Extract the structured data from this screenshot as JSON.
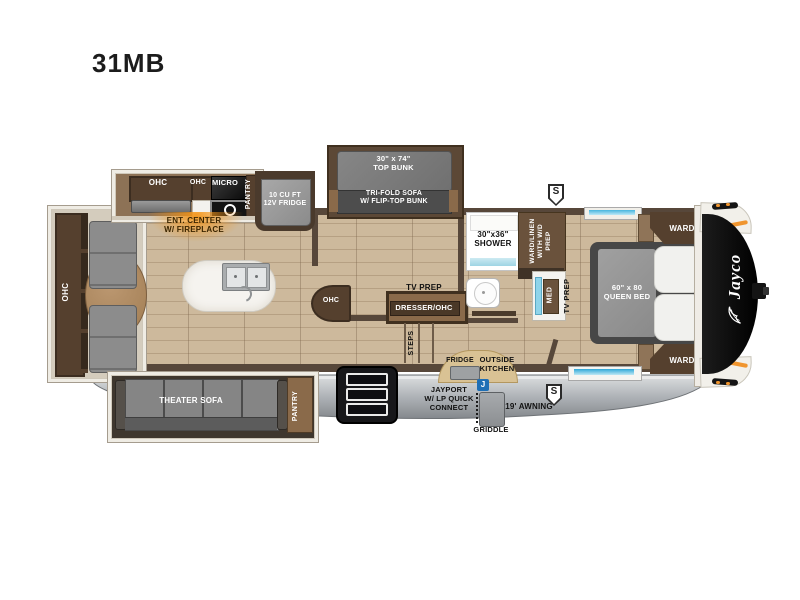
{
  "title": "31MB",
  "colors": {
    "wall_brown": "#57473a",
    "floor_tan": "#cbb79a",
    "accent_orange": "#f0952e",
    "window_blue": "#45b4dd",
    "jayport_blue": "#1f6fb5",
    "skirt_gray": "#b4b8bc"
  },
  "rear": {
    "ohc": "OHC"
  },
  "kitchen": {
    "ohc_large": "OHC",
    "ohc_small": "OHC",
    "micro": "MICRO",
    "pantry": "PANTRY",
    "fridge": "10 CU FT\n12V FRIDGE",
    "ent_center": "ENT. CENTER\nW/ FIREPLACE"
  },
  "bunkroom": {
    "top_bunk": "30\" x 74\"\nTOP BUNK",
    "sofa": "TRI-FOLD SOFA\nW/ FLIP-TOP BUNK",
    "ohc": "OHC",
    "tv_prep": "TV PREP",
    "dresser": "DRESSER/OHC",
    "steps": "STEPS"
  },
  "bath": {
    "shower": "30\"x36\"\nSHOWER",
    "ward_linen": "WARD/LINEN\nWITH W/D\nPREP",
    "med": "MED",
    "tv_prep": "TV PREP"
  },
  "bedroom": {
    "bed": "60\" x 80\nQUEEN BED",
    "ward_top": "WARD",
    "ward_bottom": "WARD"
  },
  "living": {
    "theater_sofa": "THEATER SOFA",
    "pantry": "PANTRY"
  },
  "exterior": {
    "fridge": "FRIDGE",
    "outside_kitchen": "OUTSIDE\nKITCHEN",
    "jayport": "JAYPORT\nW/ LP QUICK\nCONNECT",
    "jayport_icon": "J",
    "griddle": "GRIDDLE",
    "awning": "19' AWNING",
    "speaker_top": "S",
    "speaker_bottom": "S",
    "brand": "Jayco"
  }
}
